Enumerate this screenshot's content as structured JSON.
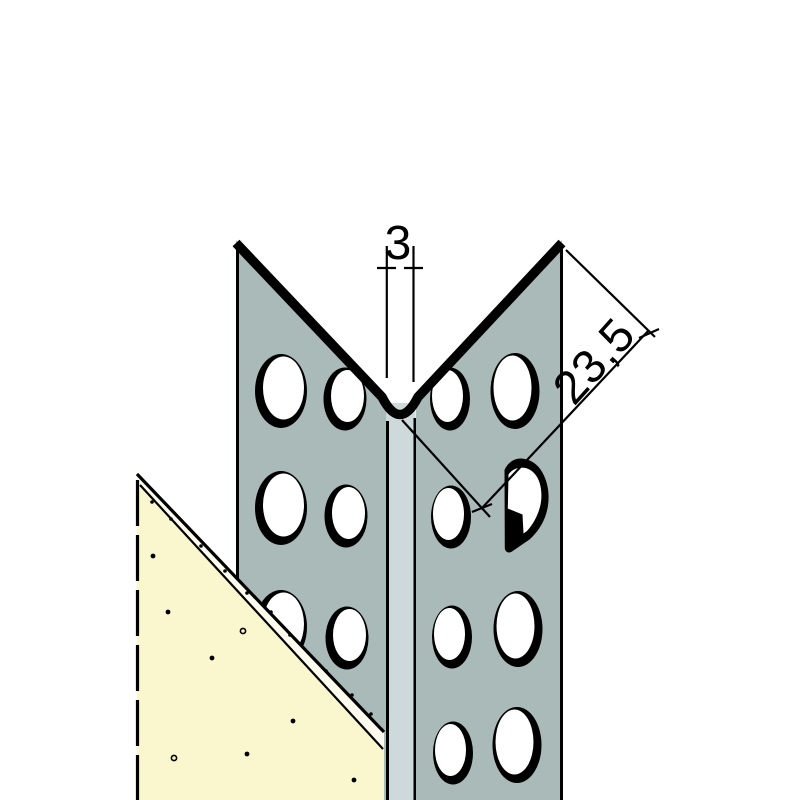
{
  "diagram": {
    "type": "technical-drawing",
    "subject": "perforated corner bead profile mounted on a plasterboard corner, axonometric section view",
    "dimensions": {
      "nose_width_label": "3",
      "flange_width_label": "23,5"
    },
    "colors": {
      "profile_face": "#a9bab9",
      "nose_strip": "#cdd9da",
      "plasterboard": "#faf6cd",
      "board_edge_band": "#fcfbee",
      "line": "#000000",
      "hole": "#ffffff",
      "background": "#ffffff"
    }
  }
}
